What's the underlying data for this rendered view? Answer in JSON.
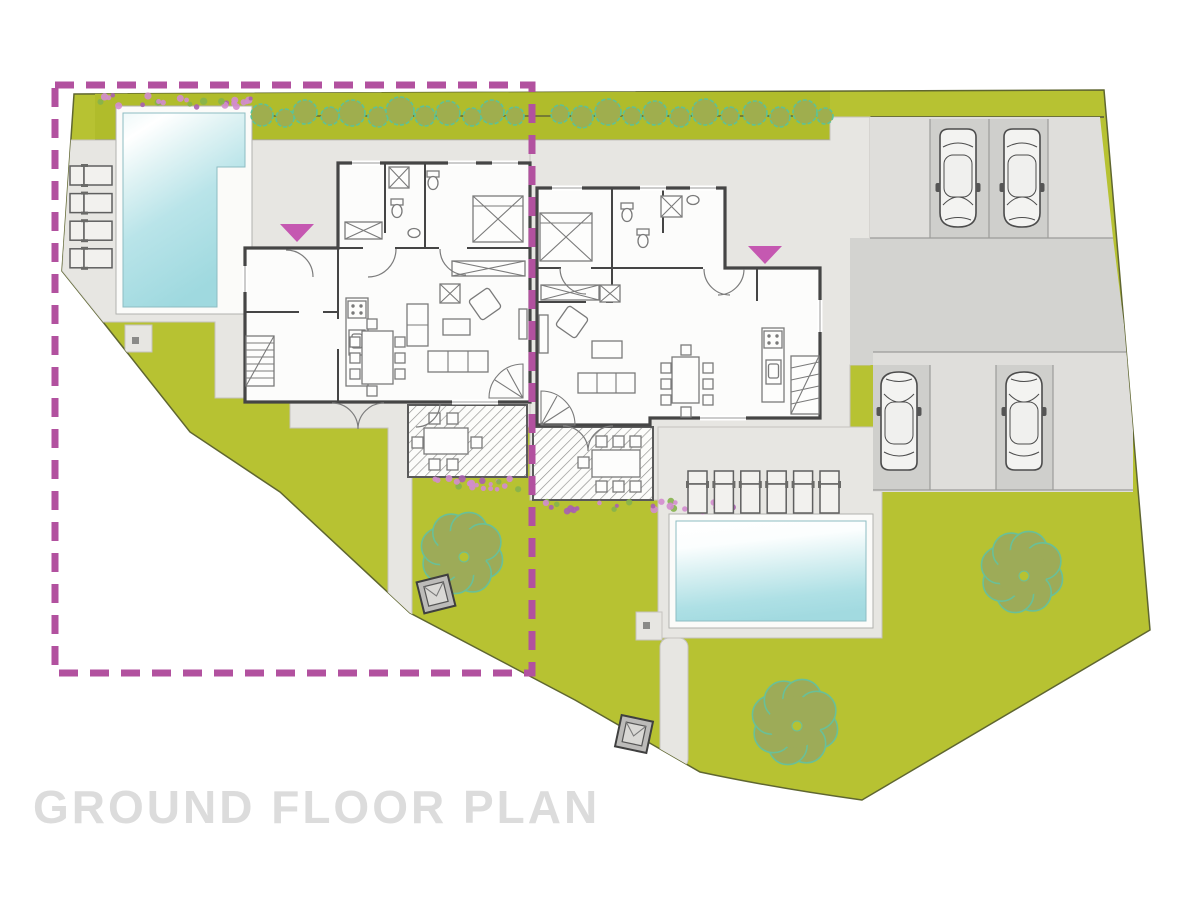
{
  "title": {
    "text": "GROUND FLOOR PLAN"
  },
  "plan": {
    "colors": {
      "pageBg": "#ffffff",
      "lawn": "#b7c232",
      "hedge": "#b0bc2b",
      "siteEdge": "#5f6630",
      "hardscape": "#e7e6e2",
      "poolSurround": "#fbfbf9",
      "driveway": "#d3d3d0",
      "apron": "#dfdedb",
      "stall": "#cfcfcc",
      "stallLine": "#9c9c99",
      "wall": "#454545",
      "furniture": "#7a7a7a",
      "roomFill": "#fcfcfb",
      "poolCyan": "#a6dce2",
      "bushFill": "#9fae4e",
      "bushStroke": "#5ec295",
      "treeFill": "#9dab58",
      "treeStroke": "#69c098",
      "boundaryMagenta": "#b2519f",
      "arrowPink": "#c558b1",
      "flowerPink": "#d38ccf",
      "flowerViolet": "#a95fb0",
      "flowerGreen": "#86b34c",
      "titleGray": "#dcdcdc",
      "utilityBox": "#bcbbb9",
      "hatchLine": "#8f8f8d"
    },
    "inventory": {
      "houses": 2,
      "pools": 2,
      "cars": 4,
      "trees": 3,
      "sun_loungers_west": 4,
      "sun_loungers_south": 6,
      "entrance_arrows": 2,
      "patios": 2,
      "utility_boxes": 2,
      "hedge_bushes": 24
    }
  }
}
